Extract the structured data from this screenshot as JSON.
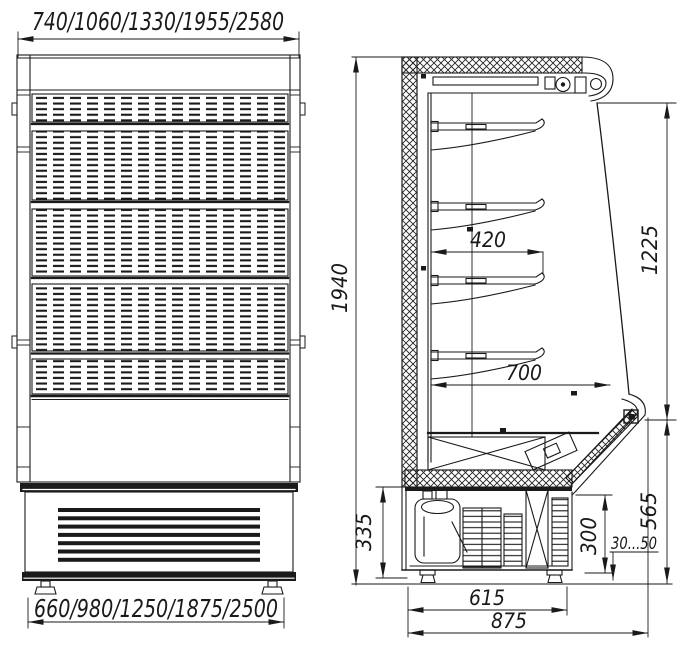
{
  "drawing": {
    "subject": "Refrigerated display cabinet — dimensional drawing (front view and side section)",
    "ink_color": "#1a1a1a",
    "background": "#ffffff",
    "front_view": {
      "overall_width": "740/1060/1330/1955/2580",
      "base_width": "660/980/1250/1875/2500"
    },
    "side_view": {
      "overall_height": "1940",
      "shelf_depth": "420",
      "opening_depth": "700",
      "opening_height": "1225",
      "machine_compartment_height": "335",
      "condenser_height": "300",
      "foot_adjustment_range": "30...50",
      "bumper_top_height": "565",
      "feet_span": "615",
      "overall_depth": "875"
    }
  }
}
